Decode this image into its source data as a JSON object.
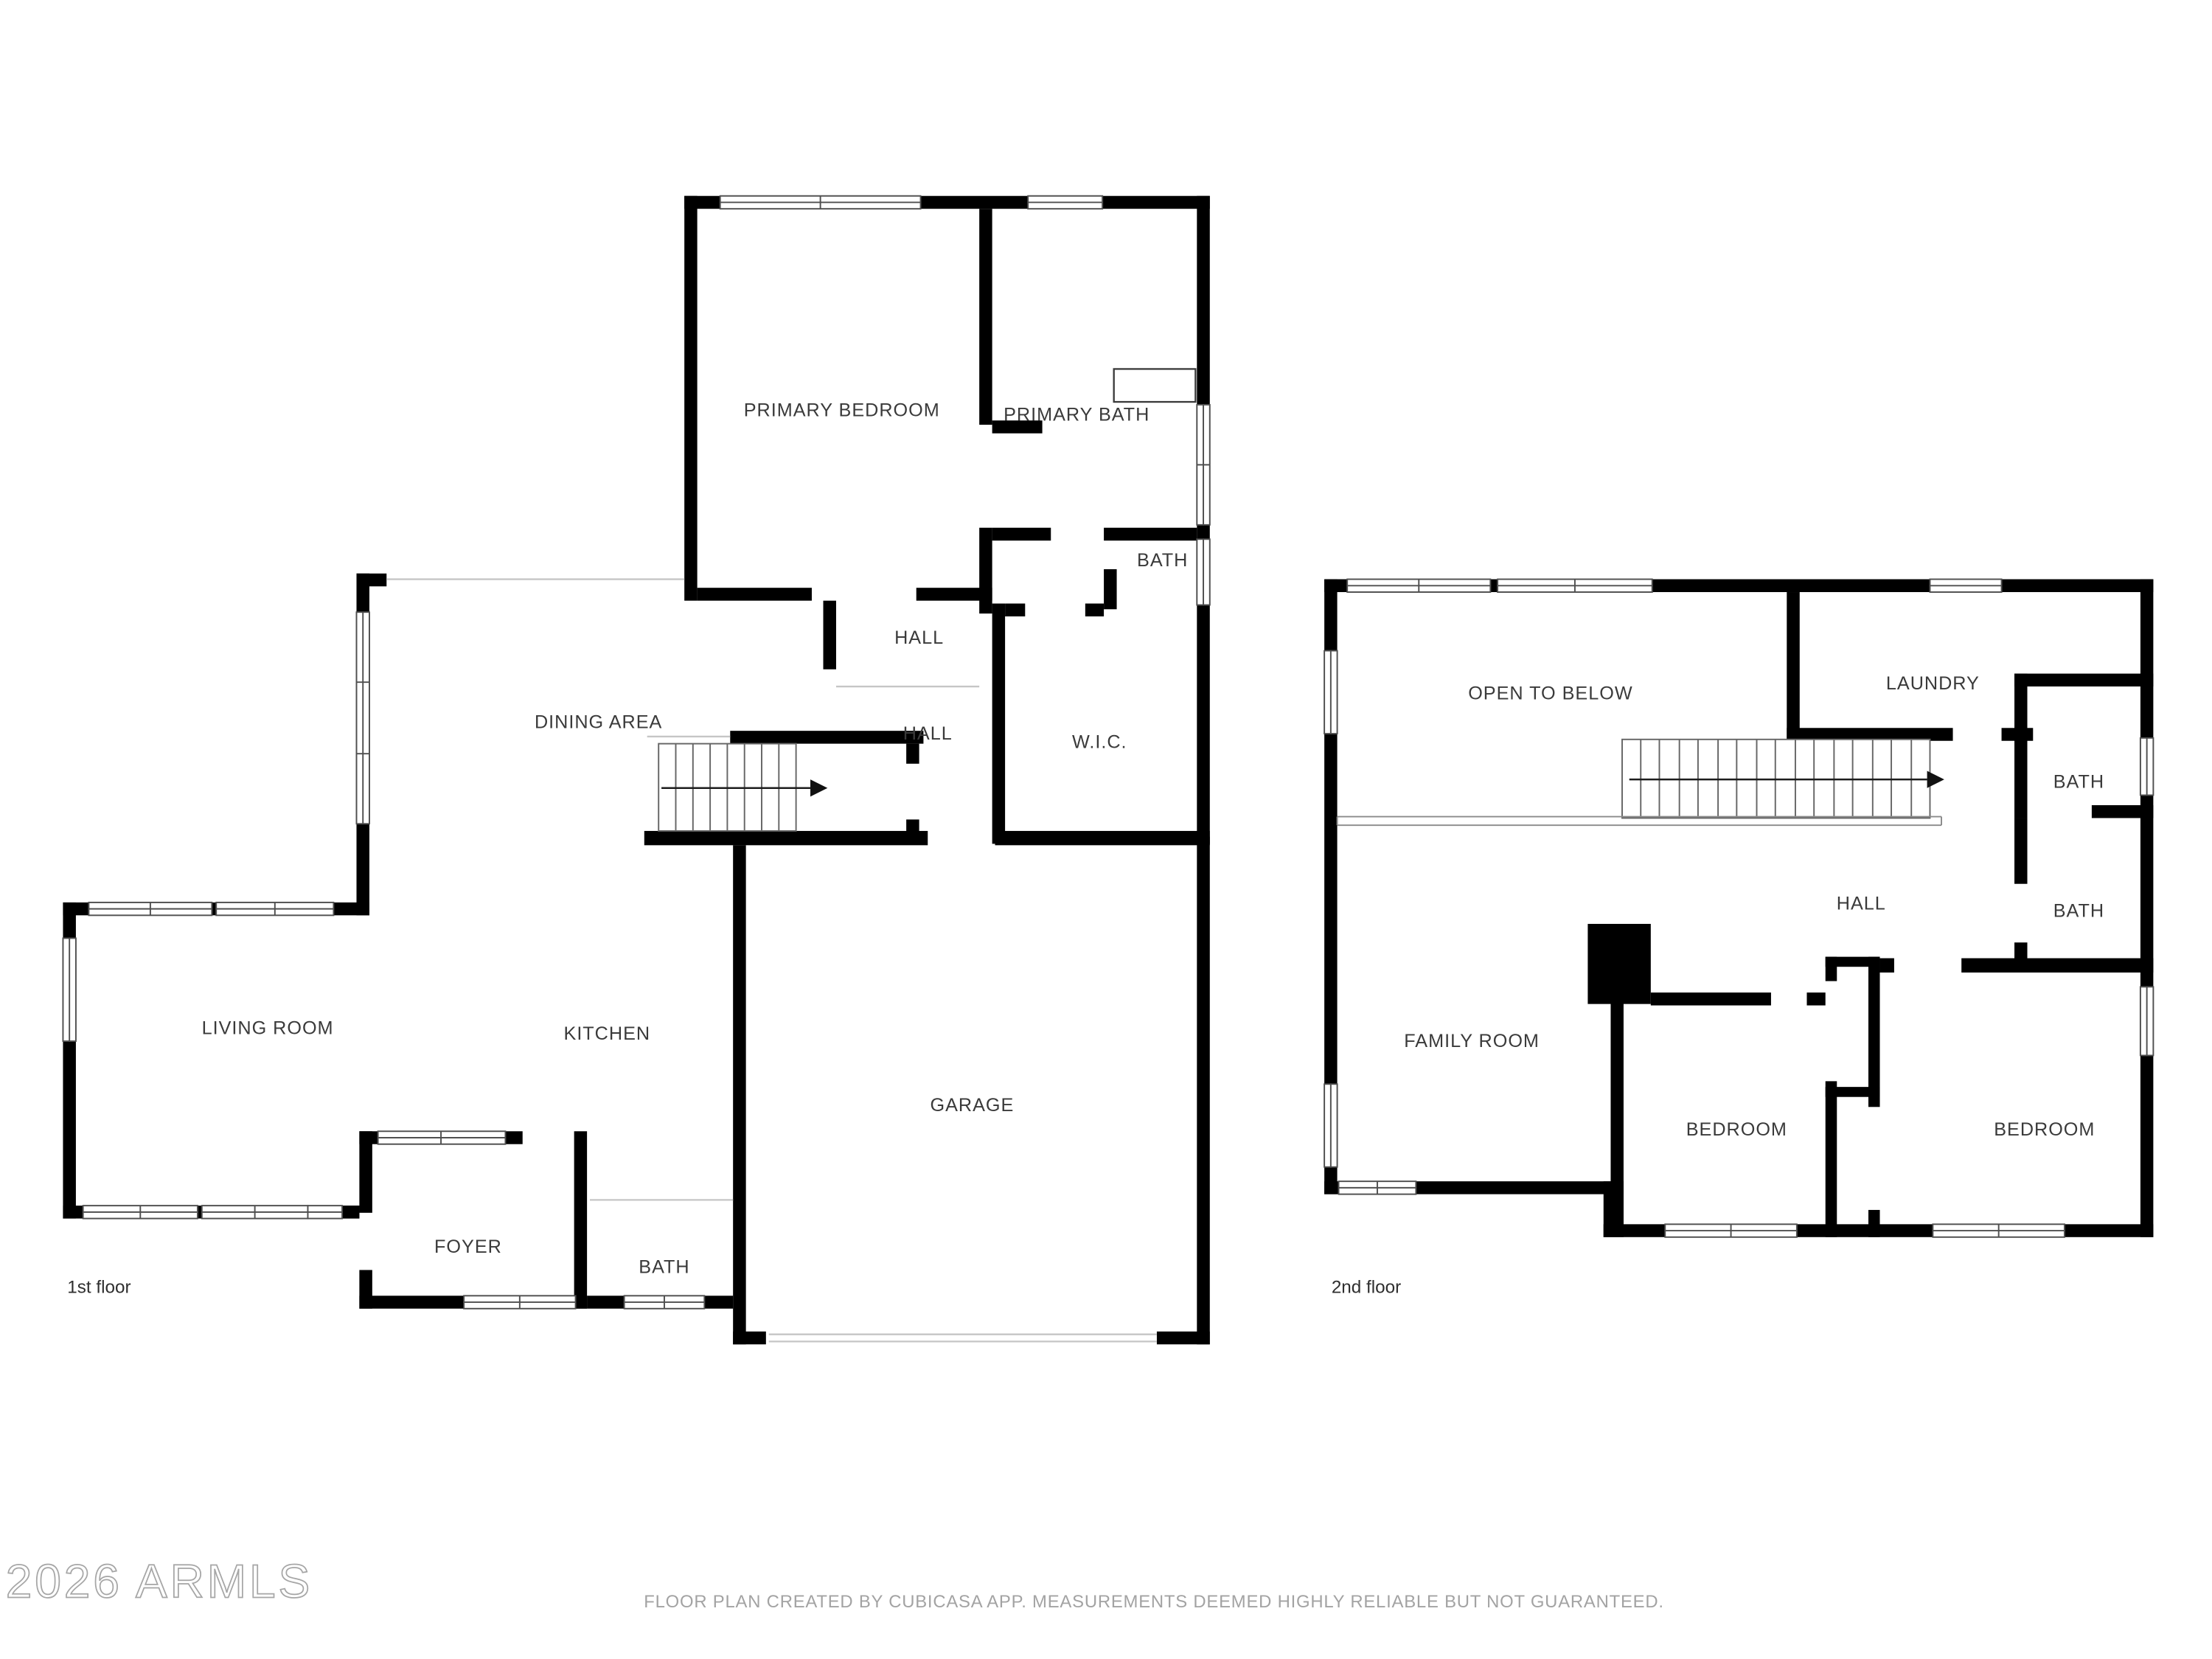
{
  "watermark": {
    "text": "2026 ARMLS"
  },
  "footer": {
    "text": "FLOOR PLAN CREATED BY CUBICASA APP. MEASUREMENTS DEEMED HIGHLY RELIABLE BUT NOT GUARANTEED."
  },
  "colors": {
    "wall": "#000000",
    "room_label": "#3a3a3a",
    "open_boundary_line": "#c6c6c6",
    "window_frame": "#4f4f4f",
    "footer_text": "#a3a3a3",
    "watermark_stroke": "#a6a6a6",
    "background": "#ffffff"
  },
  "floors": {
    "first": {
      "label": "1st floor",
      "rooms": {
        "primary_bedroom": "PRIMARY BEDROOM",
        "primary_bath": "PRIMARY BATH",
        "bath_upper": "BATH",
        "hall_upper": "HALL",
        "hall_lower": "HALL",
        "wic": "W.I.C.",
        "dining": "DINING AREA",
        "living": "LIVING ROOM",
        "kitchen": "KITCHEN",
        "garage": "GARAGE",
        "foyer": "FOYER",
        "bath_lower": "BATH"
      }
    },
    "second": {
      "label": "2nd floor",
      "rooms": {
        "open_to_below": "OPEN TO BELOW",
        "laundry": "LAUNDRY",
        "bath_upper": "BATH",
        "bath_lower": "BATH",
        "hall": "HALL",
        "family_room": "FAMILY ROOM",
        "bedroom_left": "BEDROOM",
        "bedroom_right": "BEDROOM"
      }
    }
  }
}
